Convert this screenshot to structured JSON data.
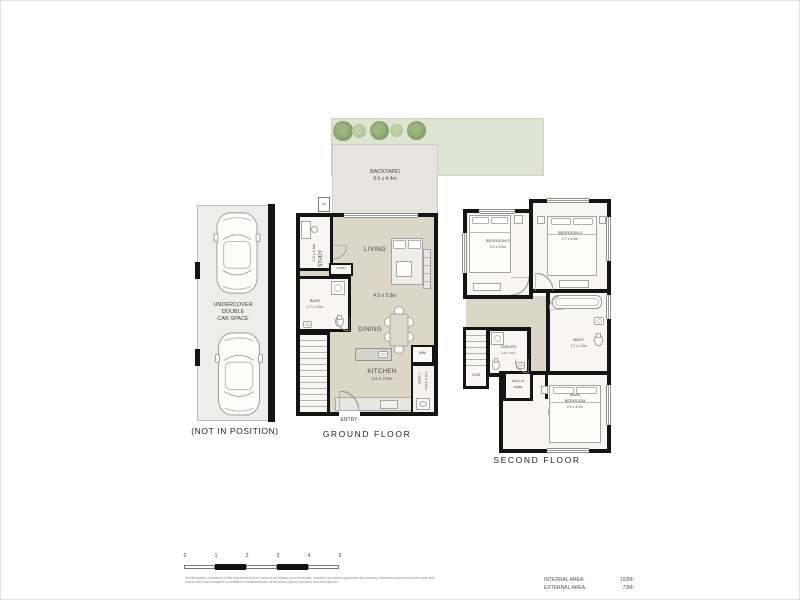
{
  "car_space": {
    "line1": "UNDERCOVER",
    "line2": "DOUBLE",
    "line3": "CAR SPACE",
    "caption": "(NOT IN POSITION)"
  },
  "backyard": {
    "name": "BACKYARD",
    "dims": "9.6 x 4.4m",
    "ac": "AC"
  },
  "ground_floor": {
    "caption": "GROUND FLOOR",
    "entry": "ENTRY",
    "study_name": "STUDY",
    "study_dims": "2.0 x 1.9m",
    "cupd": "CUP'D",
    "bath_name": "BATH",
    "bath_dims": "1.7 x 2.0m",
    "living": "LIVING",
    "living_dims": "4.0 x 5.8m",
    "dining": "DINING",
    "kitchen_name": "KITCHEN",
    "kitchen_dims": "2.6 x 2.6m",
    "wm": "WM",
    "ldry_name": "L'DRY",
    "ldry_dims": "0.8 x 2.5m"
  },
  "second_floor": {
    "caption": "SECOND FLOOR",
    "bedroom2_name": "BEDROOM 2",
    "bedroom2_dims": "3.0 x 3.0m",
    "bedroom3_name": "BEDROOM 3",
    "bedroom3_dims": "2.7 x 4.0m",
    "bath_name": "BATH",
    "bath_dims": "1.7 x 2.5m",
    "ensuite_name": "ENSUITE",
    "ensuite_dims": "1.8 x 2.0m",
    "void": "VOID",
    "wir_line1": "WALK-IN",
    "wir_line2": "ROBE",
    "main_line1": "MAIN",
    "main_line2": "BEDROOM",
    "main_dims": "2.9 x 4.2m"
  },
  "scale_bar": {
    "ticks": [
      "0",
      "1",
      "2",
      "3",
      "4",
      "5"
    ]
  },
  "footer": {
    "disclaimer": "All information contained in this document is from sources we believe to be accurate, however we cannot guarantee its accuracy. Interested persons should make and rely on their own enquiries in relation to measurements, dimensions, layout, furniture and descriptions.",
    "internal_label": "INTERNAL AREA:",
    "internal_value": "102M²",
    "external_label": "EXTERNAL AREA:",
    "external_value": "73M²"
  },
  "colors": {
    "wall": "#141414",
    "floor_beige": "#dcd6c7",
    "grass": "#dde4d1",
    "paving": "#e6e4e1",
    "carspace_bg": "#ededec",
    "tree_dark": "#7d9a63",
    "tree_light": "#a3b98a"
  }
}
